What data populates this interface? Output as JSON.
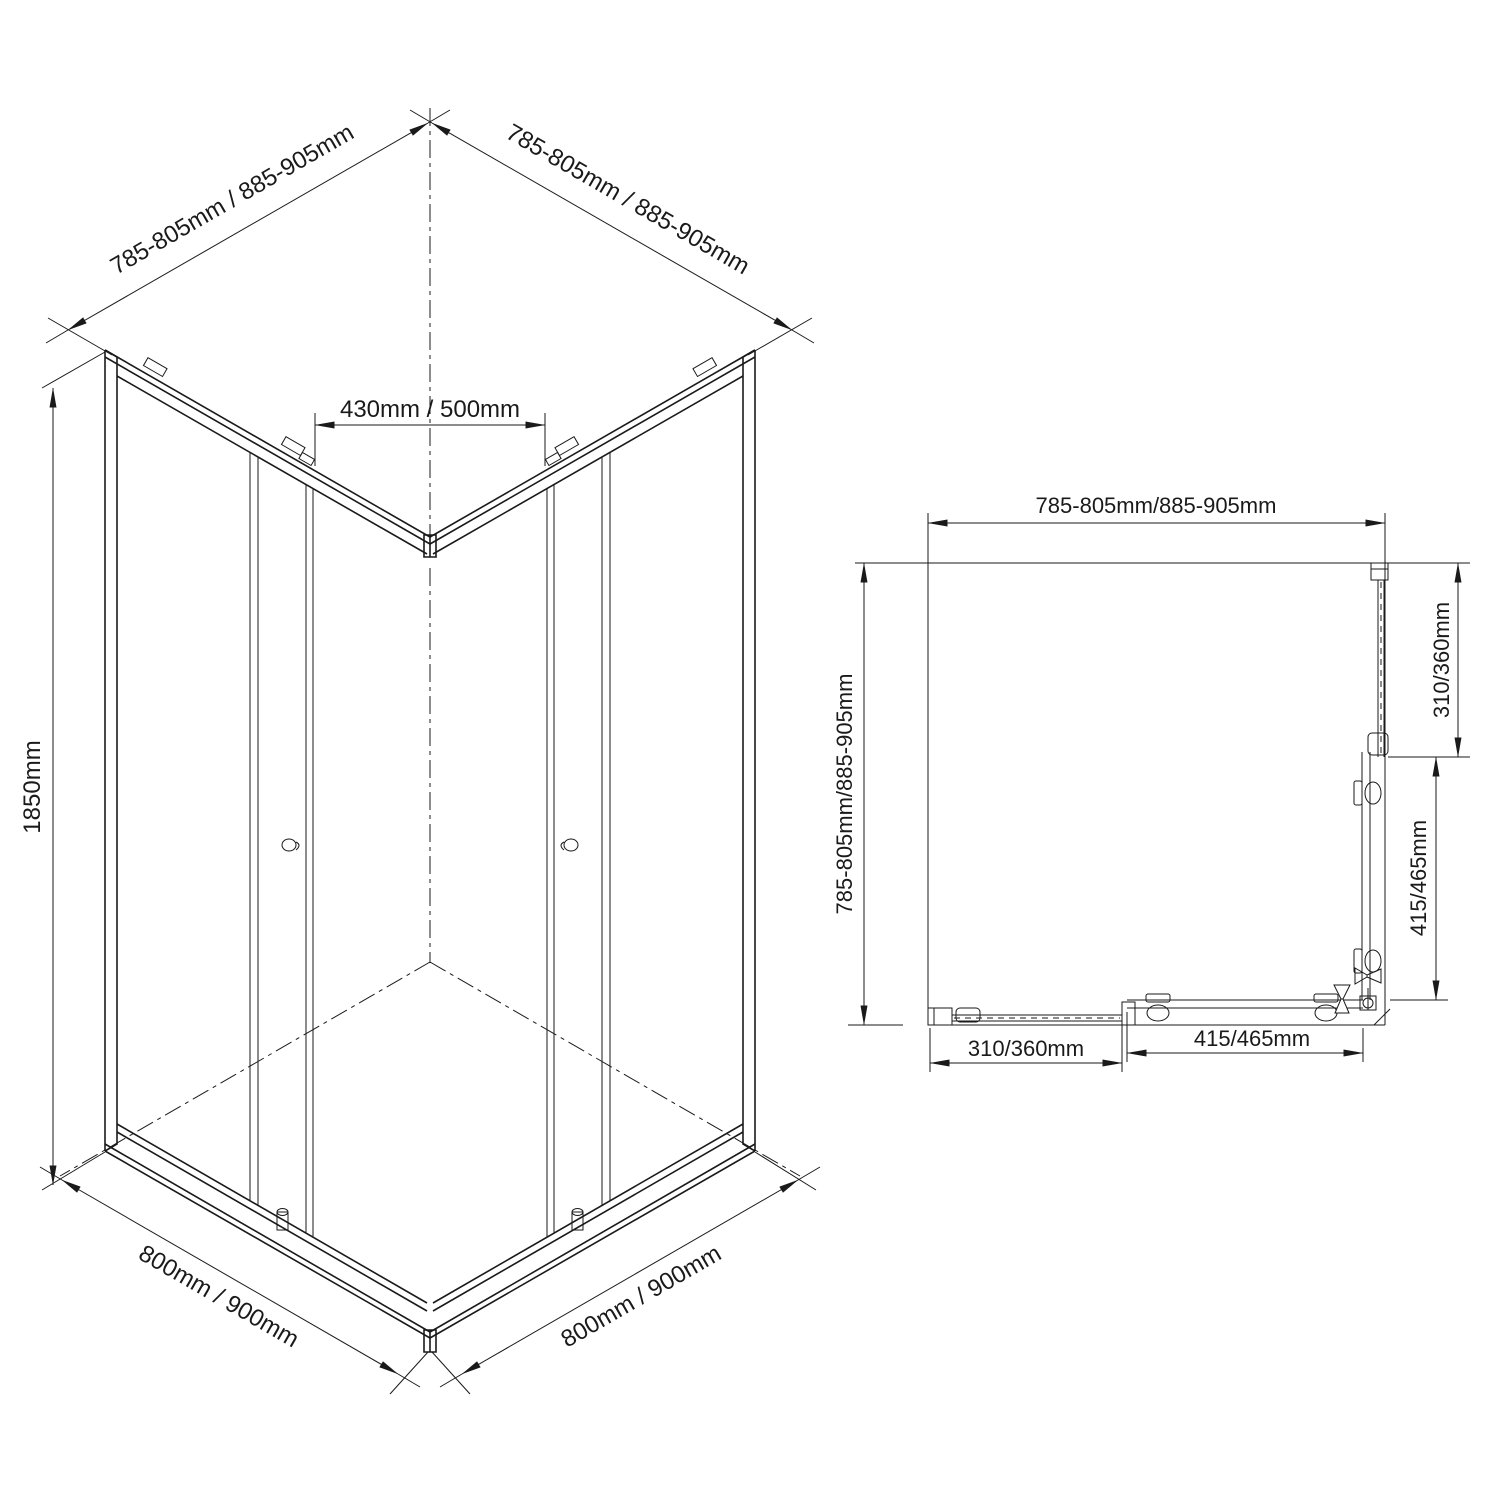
{
  "drawing": {
    "background": "#ffffff",
    "line_color": "#1a1a1a",
    "description": "Corner entry shower enclosure technical drawing with isometric and plan views"
  },
  "iso": {
    "left_width": "785-805mm / 885-905mm",
    "right_width": "785-805mm / 885-905mm",
    "height": "1850mm",
    "opening": "430mm / 500mm",
    "base_left": "800mm / 900mm",
    "base_right": "800mm / 900mm"
  },
  "plan": {
    "top_width": "785-805mm/885-905mm",
    "left_depth": "785-805mm/885-905mm",
    "right_fixed": "310/360mm",
    "right_door": "415/465mm",
    "bottom_fixed": "310/360mm",
    "bottom_door": "415/465mm"
  }
}
